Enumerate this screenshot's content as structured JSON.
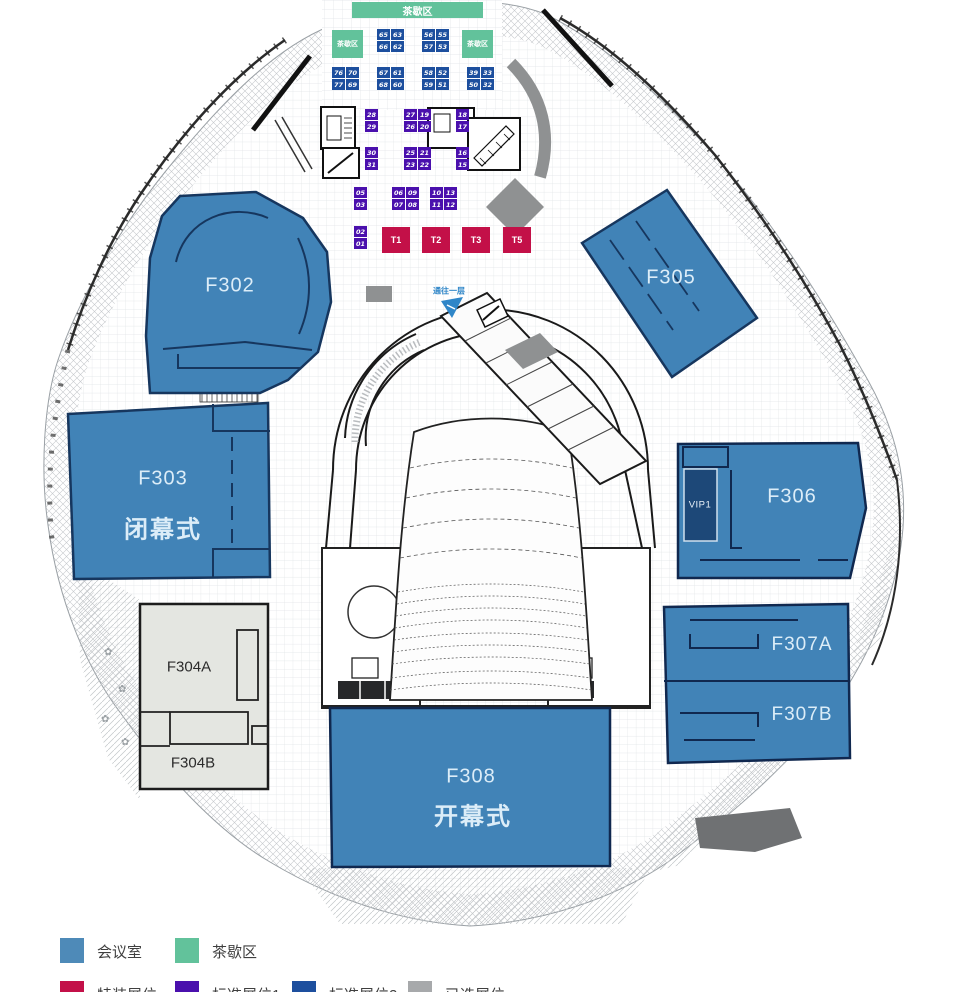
{
  "colors": {
    "room": "#4183b7",
    "room_stroke": "#16365e",
    "navy": "#1d4f9e",
    "purple": "#4a10ad",
    "red": "#c31048",
    "green": "#62c29b",
    "gray": "#8f9192",
    "room_gray": "#e4e6e1",
    "vip": "#1d4878"
  },
  "rooms": {
    "f302": {
      "label": "F302"
    },
    "f303": {
      "label": "F303",
      "sublabel": "闭幕式"
    },
    "f304a": {
      "label": "F304A"
    },
    "f304b": {
      "label": "F304B"
    },
    "f305": {
      "label": "F305"
    },
    "f306": {
      "label": "F306"
    },
    "vip1": {
      "label": "VIP1"
    },
    "f307a": {
      "label": "F307A"
    },
    "f307b": {
      "label": "F307B"
    },
    "f308": {
      "label": "F308",
      "sublabel": "开幕式"
    }
  },
  "wayfinding": {
    "label": "通往一层"
  },
  "tea_areas": [
    {
      "label": "茶歇区",
      "x": 352,
      "y": 2,
      "w": 131,
      "h": 16,
      "fs": 10
    },
    {
      "label": "茶歇区",
      "x": 332,
      "y": 30,
      "w": 31,
      "h": 28,
      "fs": 7
    },
    {
      "label": "茶歇区",
      "x": 462,
      "y": 30,
      "w": 31,
      "h": 28,
      "fs": 7
    }
  ],
  "booth_blocks": [
    {
      "color": "navy",
      "x": 377,
      "y": 29,
      "cols": 2,
      "cells": [
        "65",
        "63",
        "66",
        "62"
      ]
    },
    {
      "color": "navy",
      "x": 422,
      "y": 29,
      "cols": 2,
      "cells": [
        "56",
        "55",
        "57",
        "53"
      ]
    },
    {
      "color": "navy",
      "x": 332,
      "y": 67,
      "cols": 2,
      "cells": [
        "76",
        "70",
        "77",
        "69"
      ]
    },
    {
      "color": "navy",
      "x": 377,
      "y": 67,
      "cols": 2,
      "cells": [
        "67",
        "61",
        "68",
        "60"
      ]
    },
    {
      "color": "navy",
      "x": 422,
      "y": 67,
      "cols": 2,
      "cells": [
        "58",
        "52",
        "59",
        "51"
      ]
    },
    {
      "color": "navy",
      "x": 467,
      "y": 67,
      "cols": 2,
      "cells": [
        "39",
        "33",
        "50",
        "32"
      ]
    },
    {
      "color": "purple",
      "x": 365,
      "y": 109,
      "cols": 1,
      "cells": [
        "28",
        "29"
      ]
    },
    {
      "color": "purple",
      "x": 404,
      "y": 109,
      "cols": 2,
      "cells": [
        "27",
        "19",
        "26",
        "20"
      ]
    },
    {
      "color": "purple",
      "x": 456,
      "y": 109,
      "cols": 1,
      "cells": [
        "18",
        "17"
      ]
    },
    {
      "color": "purple",
      "x": 365,
      "y": 147,
      "cols": 1,
      "cells": [
        "30",
        "31"
      ]
    },
    {
      "color": "purple",
      "x": 404,
      "y": 147,
      "cols": 2,
      "cells": [
        "25",
        "21",
        "23",
        "22"
      ]
    },
    {
      "color": "purple",
      "x": 456,
      "y": 147,
      "cols": 1,
      "cells": [
        "16",
        "15"
      ]
    },
    {
      "color": "purple",
      "x": 354,
      "y": 187,
      "cols": 1,
      "cells": [
        "05",
        "03"
      ]
    },
    {
      "color": "purple",
      "x": 392,
      "y": 187,
      "cols": 2,
      "cells": [
        "06",
        "09",
        "07",
        "08"
      ]
    },
    {
      "color": "purple",
      "x": 430,
      "y": 187,
      "cols": 2,
      "cells": [
        "10",
        "13",
        "11",
        "12"
      ]
    },
    {
      "color": "purple",
      "x": 354,
      "y": 226,
      "cols": 1,
      "cells": [
        "02",
        "01"
      ]
    }
  ],
  "t_booths": [
    {
      "label": "T1",
      "x": 382,
      "y": 227
    },
    {
      "label": "T2",
      "x": 422,
      "y": 227
    },
    {
      "label": "T3",
      "x": 462,
      "y": 227
    },
    {
      "label": "T5",
      "x": 503,
      "y": 227
    }
  ],
  "legend": {
    "items": [
      {
        "label": "会议室",
        "color": "#4e8ab8",
        "row": 0,
        "col": 0
      },
      {
        "label": "茶歇区",
        "color": "#62c29b",
        "row": 0,
        "col": 1
      },
      {
        "label": "特装展位",
        "color": "#c31048",
        "row": 1,
        "col": 0
      },
      {
        "label": "标准展位1",
        "color": "#4a10ad",
        "row": 1,
        "col": 1
      },
      {
        "label": "标准展位2",
        "color": "#1d4f9e",
        "row": 1,
        "col": 2
      },
      {
        "label": "已选展位",
        "color": "#a7a9ab",
        "row": 1,
        "col": 3
      }
    ]
  }
}
